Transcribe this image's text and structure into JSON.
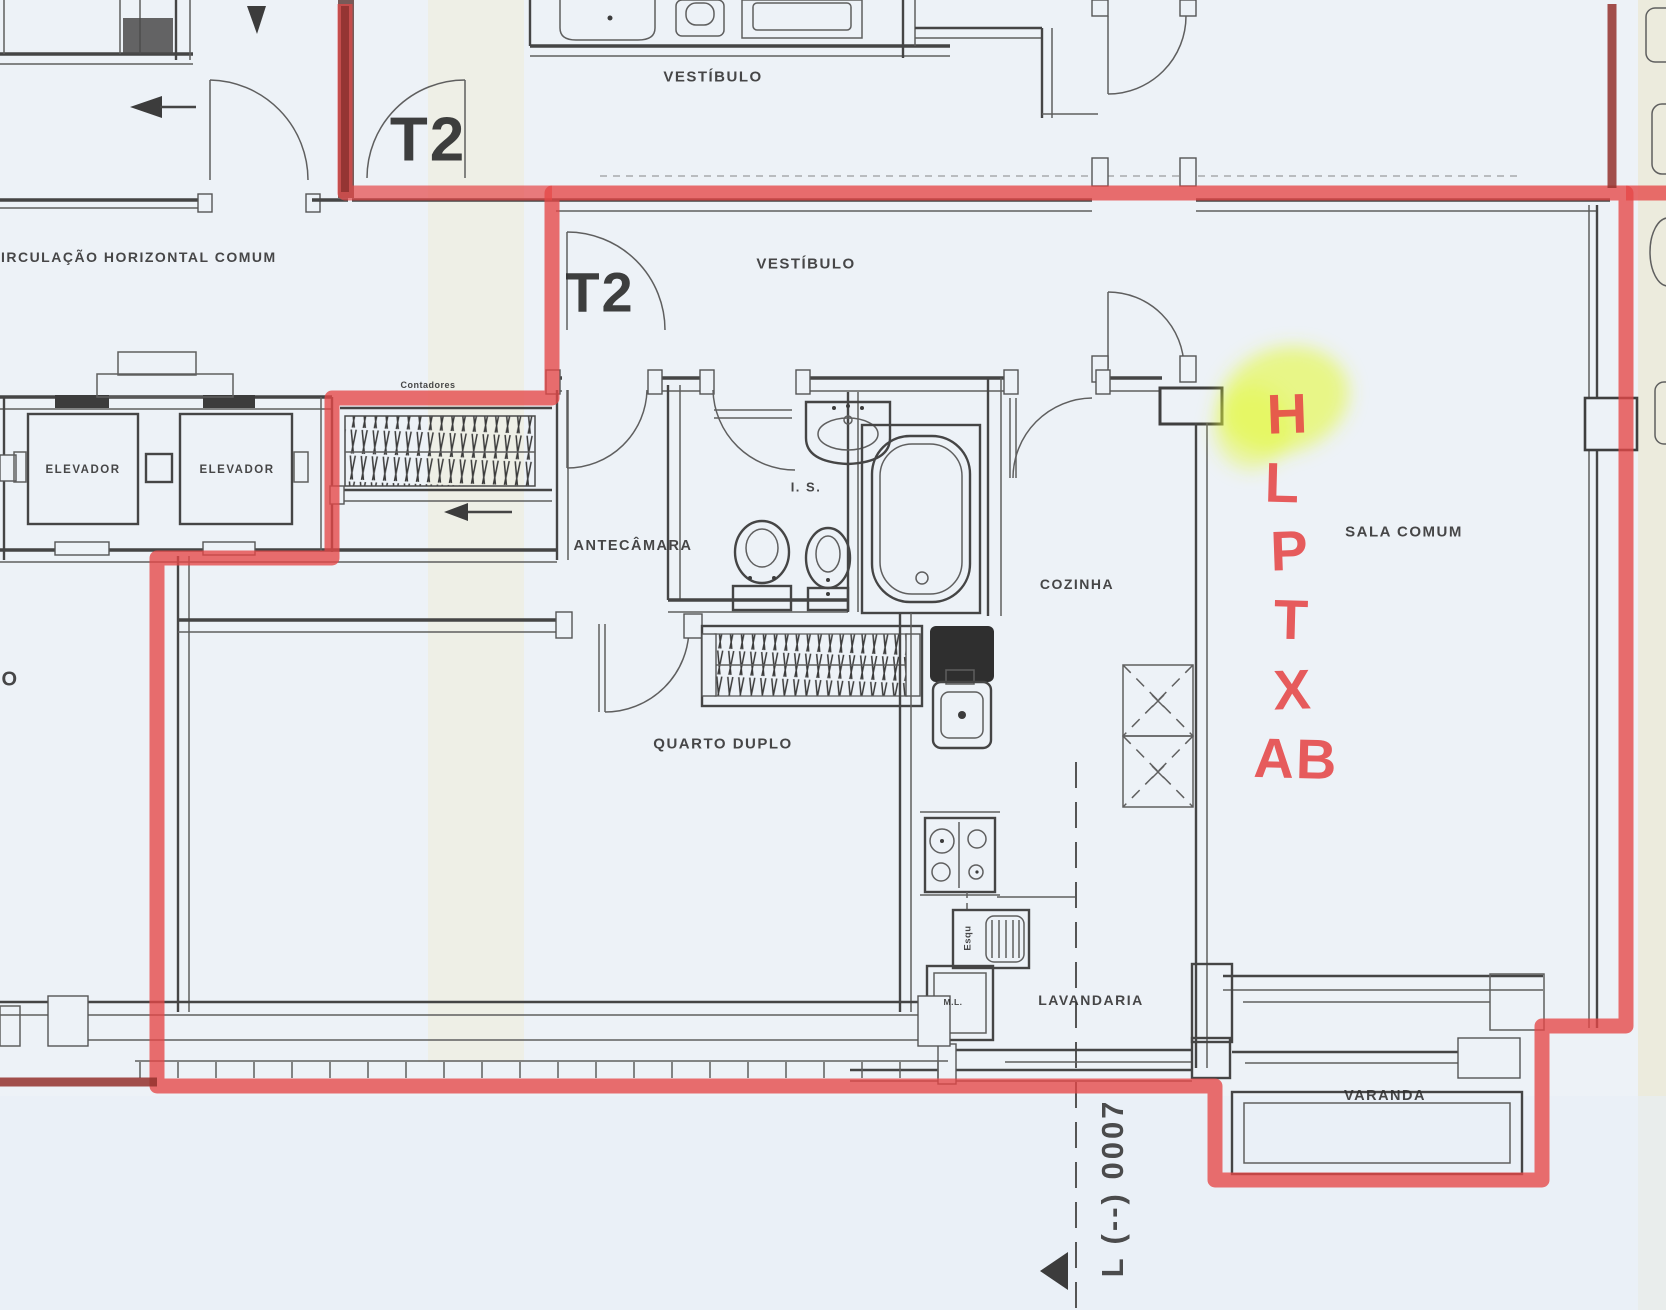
{
  "colors": {
    "paper": "#edf2f7",
    "ink": "#2f2f2f",
    "wall_gray": "#454545",
    "boundary_red": "#e64747",
    "boundary_dark_red": "#93312d",
    "highlight_yellow": "#e4f83c",
    "scan_yellow": "#f0ead0"
  },
  "corridor": {
    "label": "CIRCULAÇÃO HORIZONTAL COMUM"
  },
  "units": {
    "neighbor_tag": "T2",
    "unit_tag": "T2"
  },
  "rooms": {
    "vestibulo_neighbor": "VESTÍBULO",
    "vestibulo": "VESTÍBULO",
    "antecamara": "ANTECÂMARA",
    "is": "I. S.",
    "cozinha": "COZINHA",
    "sala_comum": "SALA COMUM",
    "quarto_duplo": "QUARTO DUPLO",
    "lavandaria": "LAVANDARIA",
    "varanda": "VARANDA",
    "elevador_1": "ELEVADOR",
    "elevador_2": "ELEVADOR",
    "contadores": "Contadores"
  },
  "equipment": {
    "ml": "M.L.",
    "esq": "Esqu"
  },
  "annotations": {
    "red_letters": [
      "H",
      "L",
      "P",
      "T",
      "X",
      "AB"
    ],
    "highlighted_letter": "H",
    "plan_code": "L (--) 0007",
    "partial_letter_left": "O"
  }
}
